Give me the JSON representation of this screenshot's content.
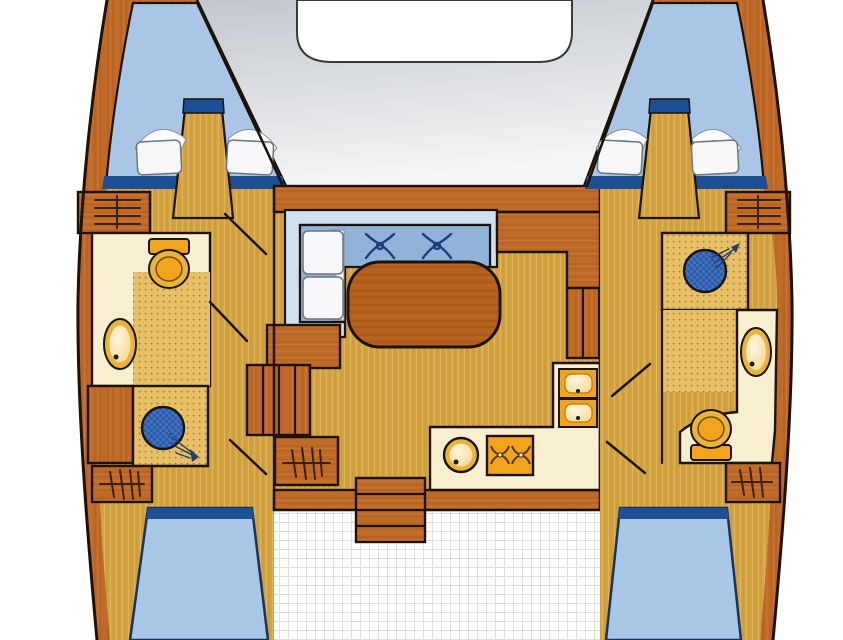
{
  "diagram": {
    "type": "boat-floor-plan",
    "vessel": "catamaran",
    "hulls": 2,
    "cabins": 4,
    "heads": 2,
    "showers": 2
  },
  "colors": {
    "background": "#ffffff",
    "outline": "#1c1208",
    "hull_wood": "#c06a28",
    "hull_wood_dark": "#a8561e",
    "floor_tan": "#d3a440",
    "floor_dotted": "#e6bf66",
    "deck_gray": "#c3c7cd",
    "deck_gray_light": "#f4f5f6",
    "trampoline_white": "#ffffff",
    "cockpit_white": "#ffffff",
    "cockpit_grid_line": "#e2dede",
    "berth_blue": "#a9c6e6",
    "berth_edge_blue": "#1d4f94",
    "sofa_back_blue": "#cfe0ee",
    "sofa_seat_blue": "#8fb3d9",
    "decor_navy": "#1d3f7a",
    "shower_blue": "#3566b8",
    "counter_cream": "#f8efd0",
    "fixture_orange": "#f2a41c",
    "fixture_gold": "#e8b43c",
    "basin_cream": "#fdf3d4",
    "pillow_white": "#f5f7f9",
    "table_wood": "#b4601e",
    "burner_brown": "#5a3808"
  },
  "rooms": {
    "foredeck": "foredeck-trampoline",
    "port_forward_cabin": "port-forward-berth",
    "starboard_forward_cabin": "starboard-forward-berth",
    "port_head": "port-head",
    "starboard_head": "starboard-head",
    "salon": "salon",
    "galley": "galley",
    "cockpit": "cockpit",
    "port_aft_cabin": "port-aft-berth",
    "starboard_aft_cabin": "starboard-aft-berth"
  },
  "fixtures": {
    "toilets": 2,
    "washbasins": 2,
    "showers": 2,
    "galley_round_sink": 1,
    "galley_double_sink_bowls": 2,
    "stove_burners": 2,
    "salon_table": 1,
    "sofa_cushions_x_motif": 2,
    "pillows_forward": 4,
    "sofa_pillows": 2,
    "companionway_ladders": 4,
    "step_flights": 3
  }
}
